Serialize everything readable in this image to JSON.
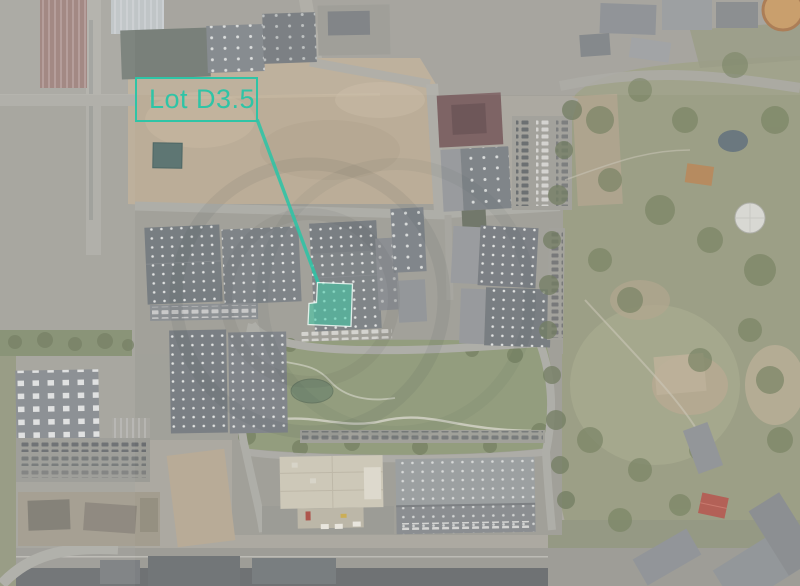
{
  "annotation": {
    "label_text": "Lot D3.5",
    "accent_color": "#2FC4A6",
    "leader_line": {
      "x1": 257.5,
      "y1": 120.5,
      "x2": 318,
      "y2": 282.5
    },
    "highlight": {
      "points": "317.5,282.5 352.5,284 351,326.5 308,324.5 309,303.5 316.5,302.5",
      "fill_color": "#3ECCA8",
      "fill_opacity": 0.55,
      "outline_color": "#F0FAF6"
    }
  }
}
